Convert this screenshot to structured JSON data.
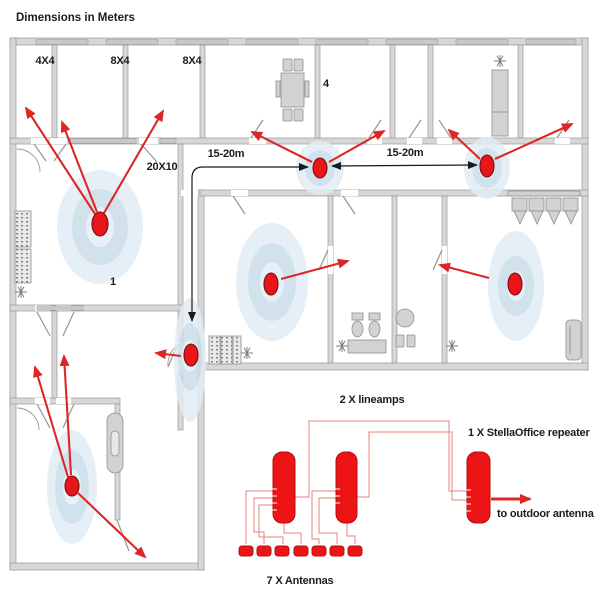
{
  "title": "Dimensions in Meters",
  "floor_plan": {
    "room_labels": {
      "small_room": "4X4",
      "medium_room_1": "8X4",
      "medium_room_2": "8X4",
      "meeting_room": "4",
      "large_room": "20X10",
      "antenna_zone": "1"
    },
    "distance_labels": {
      "left": "15-20m",
      "right": "15-20m"
    },
    "antenna_count_on_plan": 7
  },
  "schematic": {
    "lineamps_label": "2 X lineamps",
    "repeater_label": "1 X StellaOffice repeater",
    "outdoor_antenna_label": "to outdoor antenna",
    "antennas_label": "7 X Antennas"
  },
  "icons": {
    "snowflake": "✳",
    "antenna_dot": "●",
    "signal_halo": "◎"
  },
  "colors": {
    "antenna_red": "#e8151b",
    "arrow_red": "#dd2626",
    "halo_blue": "#cbdde9",
    "wall_gray": "#d7d7d7",
    "wire_salmon": "#e8827e",
    "dimension_black": "#1a1a1a"
  }
}
